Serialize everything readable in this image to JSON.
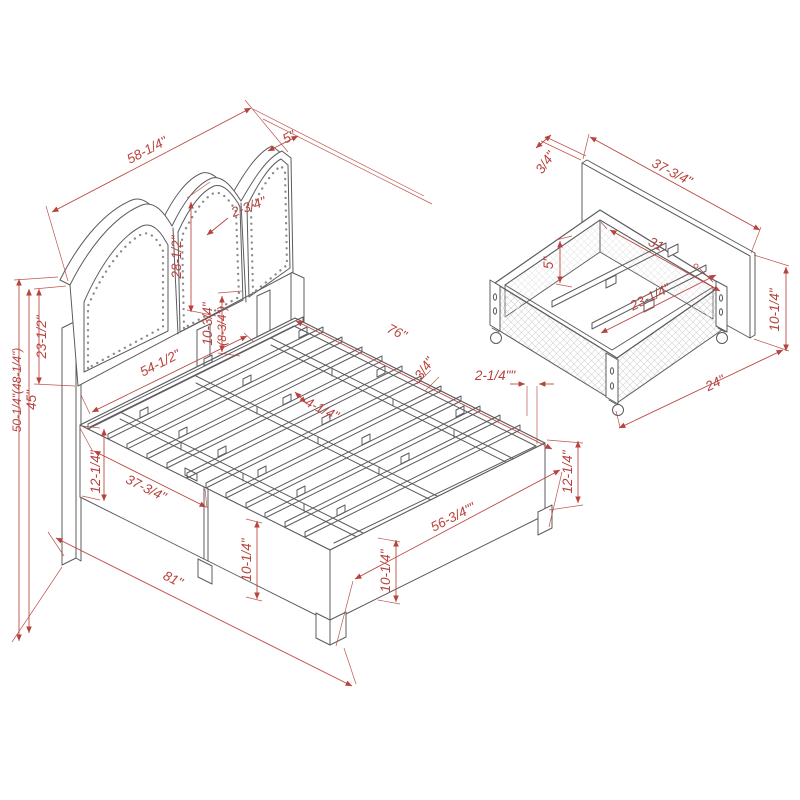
{
  "diagram": {
    "kind": "furniture-dimension-diagram",
    "subject": "Upholstered storage bed with arched nailhead headboard and rolling under-bed storage drawer",
    "colors": {
      "dimension": "#b8433d",
      "line_art": "#5c5c60",
      "hatch": "#d3d3d3"
    }
  },
  "views": {
    "bed": {
      "label": "Bed frame isometric view",
      "dims": {
        "headboard_width": "58-1/4\"",
        "headboard_thickness": "5\"",
        "panel_gap": "2-3/4\"",
        "panel_height": "28-1/2\"",
        "deck_to_rail_primary": "10-3/4\"",
        "deck_to_rail_alt": "(8-3/4\")",
        "inner_width": "54-1/2\"",
        "upholstery_height": "23-1/2\"",
        "headboard_height": "45\"",
        "overall_height": "50-1/4\"(48-1/4\")",
        "frame_length": "76\"",
        "slat_thickness": "3/4\"",
        "rail_offset": "2-1/4\"\"",
        "slat_spacing": "4-1/4\"",
        "side_rail_height": "12-1/4\"",
        "drawer_front_width": "37-3/4\"",
        "overall_length": "81\"",
        "drawer_front_height": "10-1/4\"",
        "footboard_width": "56-3/4\"\"",
        "footboard_height": "10-1/4\"",
        "footboard_rail_height": "12-1/4\""
      }
    },
    "drawer": {
      "label": "Storage drawer isometric view",
      "dims": {
        "panel_thickness": "3/4\"",
        "panel_width": "37-3/4\"",
        "inner_length": "31",
        "inner_depth": "5\"",
        "inner_width": "23-1/4\"",
        "panel_height": "10-1/4\"",
        "drawer_depth": "24\""
      }
    }
  }
}
